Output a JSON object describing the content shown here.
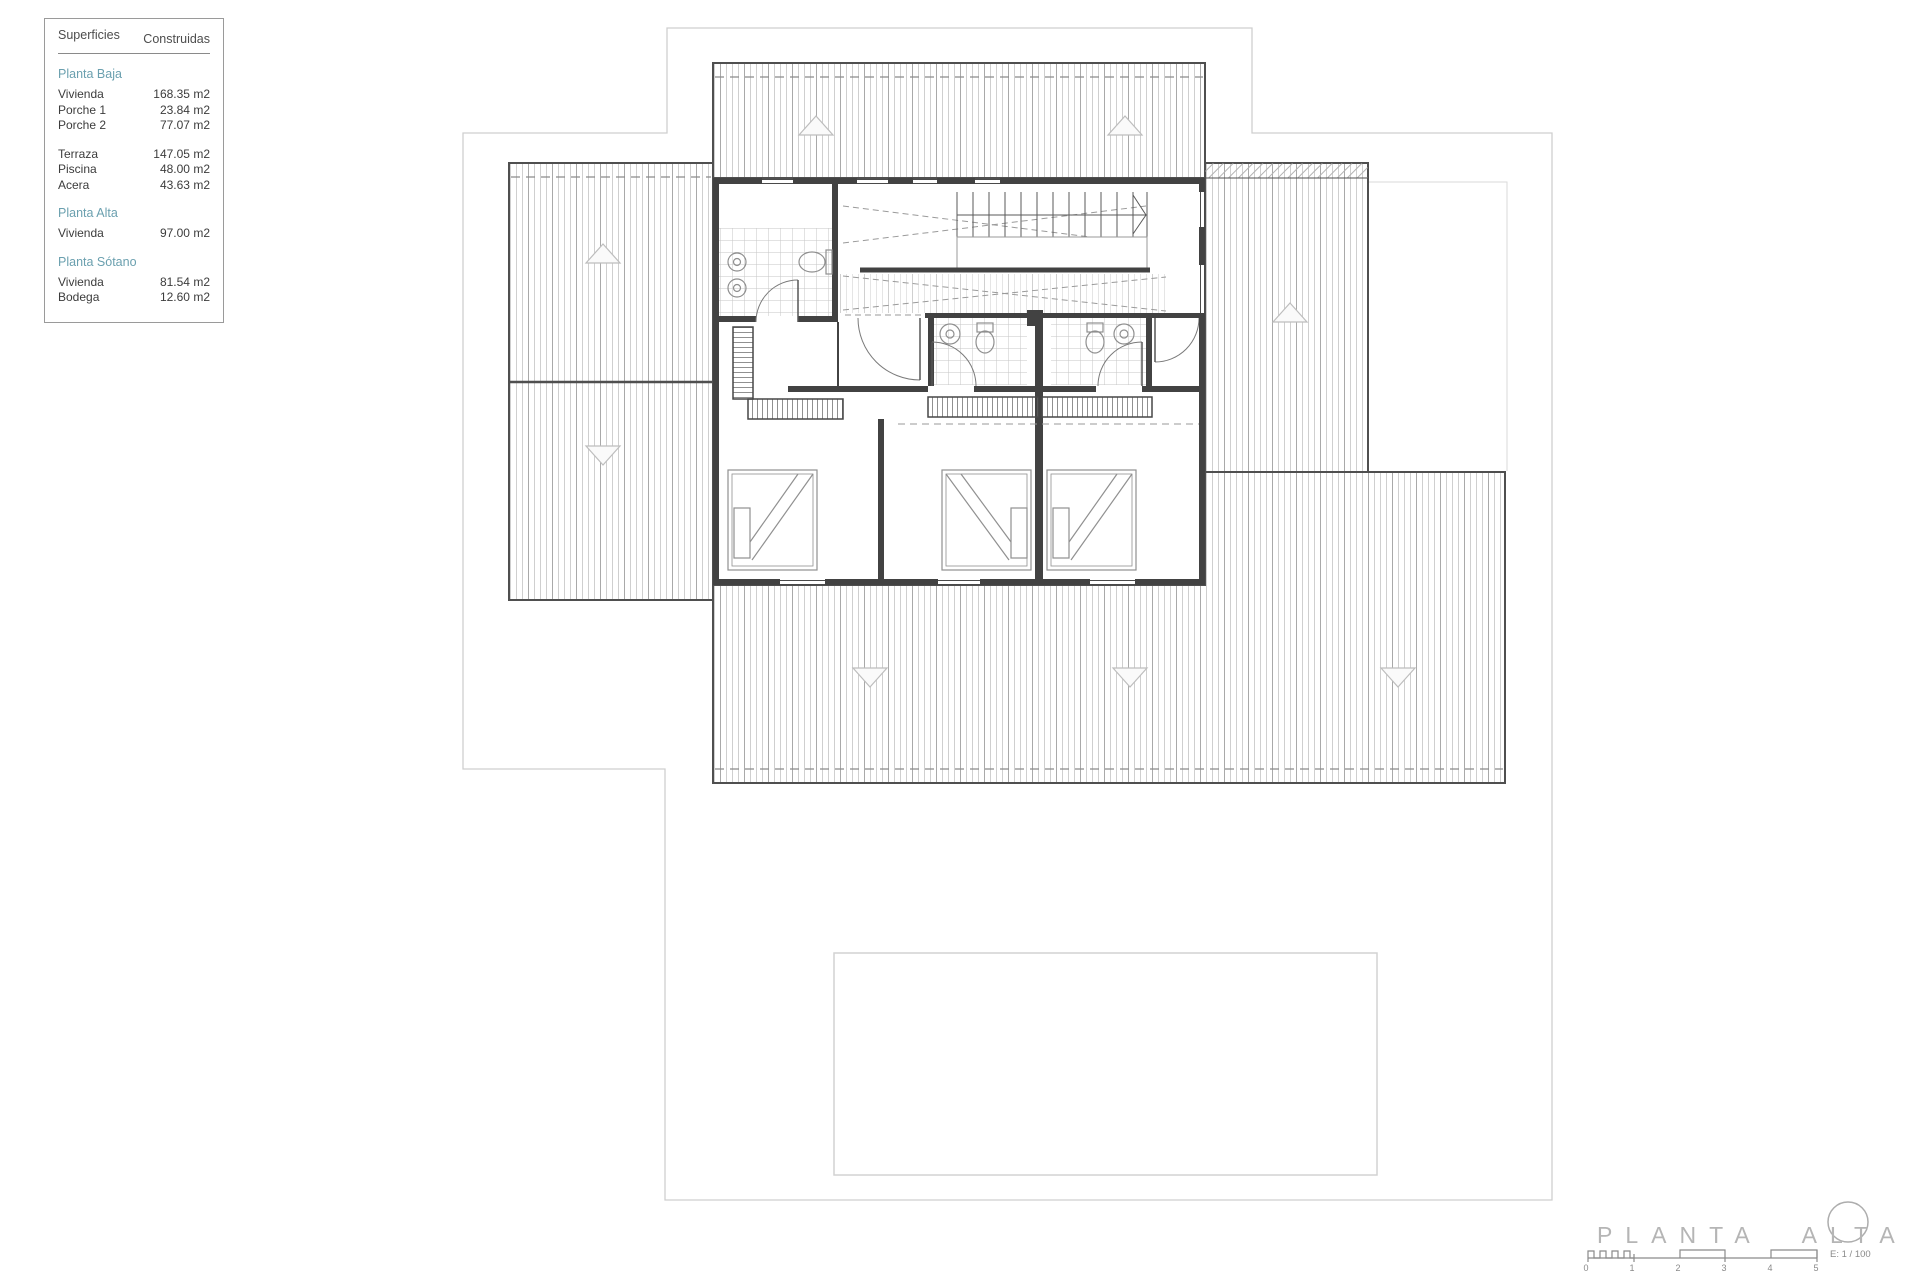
{
  "legend": {
    "col1": "Superficies",
    "col2": "Construidas",
    "sections": [
      {
        "header": "Planta Baja",
        "rows": [
          {
            "label": "Vivienda",
            "value": "168.35 m2"
          },
          {
            "label": "Porche 1",
            "value": "23.84 m2"
          },
          {
            "label": "Porche 2",
            "value": "77.07 m2"
          }
        ]
      },
      {
        "header": "",
        "rows": [
          {
            "label": "Terraza",
            "value": "147.05 m2"
          },
          {
            "label": "Piscina",
            "value": "48.00 m2"
          },
          {
            "label": "Acera",
            "value": "43.63 m2"
          }
        ]
      },
      {
        "header": "Planta Alta",
        "rows": [
          {
            "label": "Vivienda",
            "value": "97.00 m2"
          }
        ]
      },
      {
        "header": "Planta Sótano",
        "rows": [
          {
            "label": "Vivienda",
            "value": "81.54 m2"
          },
          {
            "label": "Bodega",
            "value": "12.60 m2"
          }
        ]
      }
    ]
  },
  "footer": {
    "title": "PLANTA ALTA",
    "scale_label": "E: 1 / 100",
    "scale_ticks": [
      "0",
      "1",
      "2",
      "3",
      "4",
      "5"
    ]
  },
  "colors": {
    "section_header": "#6ba0af",
    "wall_dark": "#424242",
    "roof_hatch": "#c9c9c9",
    "plot_boundary": "#cfcfcf",
    "title_gray": "#b5b5b5"
  }
}
